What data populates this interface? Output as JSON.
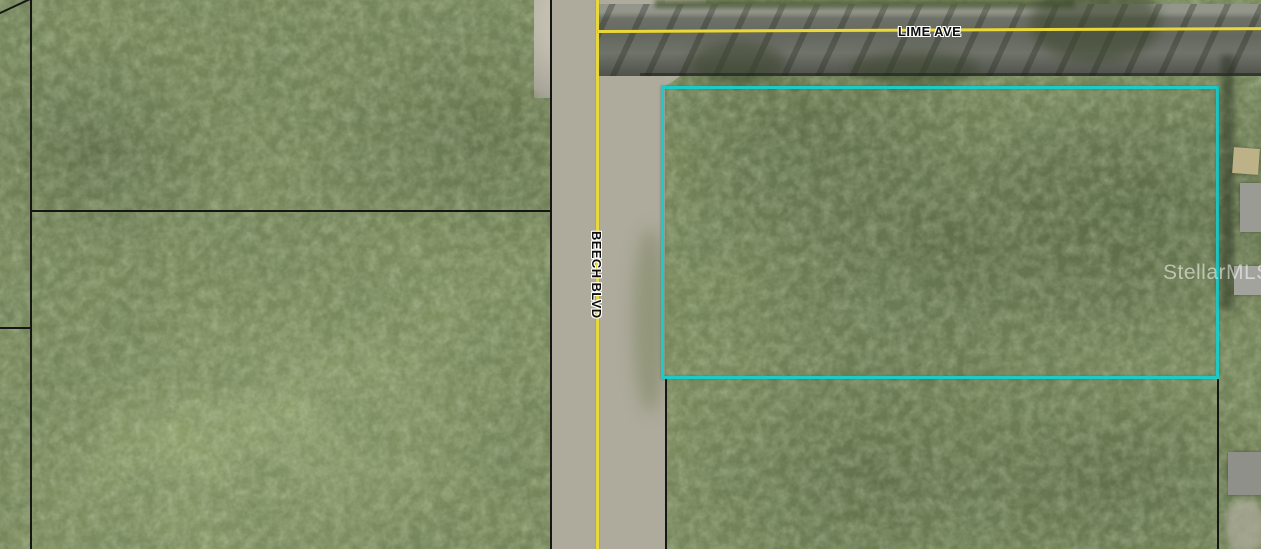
{
  "map": {
    "watermark_text": "StellarMLS",
    "streets": [
      {
        "name": "LIME AVE",
        "orientation": "horizontal"
      },
      {
        "name": "BEECH BLVD",
        "orientation": "vertical"
      }
    ],
    "colors": {
      "centerline": "#e9d83b",
      "parcel_highlight": "#1ecac6",
      "parcel_lines": "#161614",
      "label_text": "#0e0e0e",
      "label_halo": "#ffffff"
    }
  }
}
